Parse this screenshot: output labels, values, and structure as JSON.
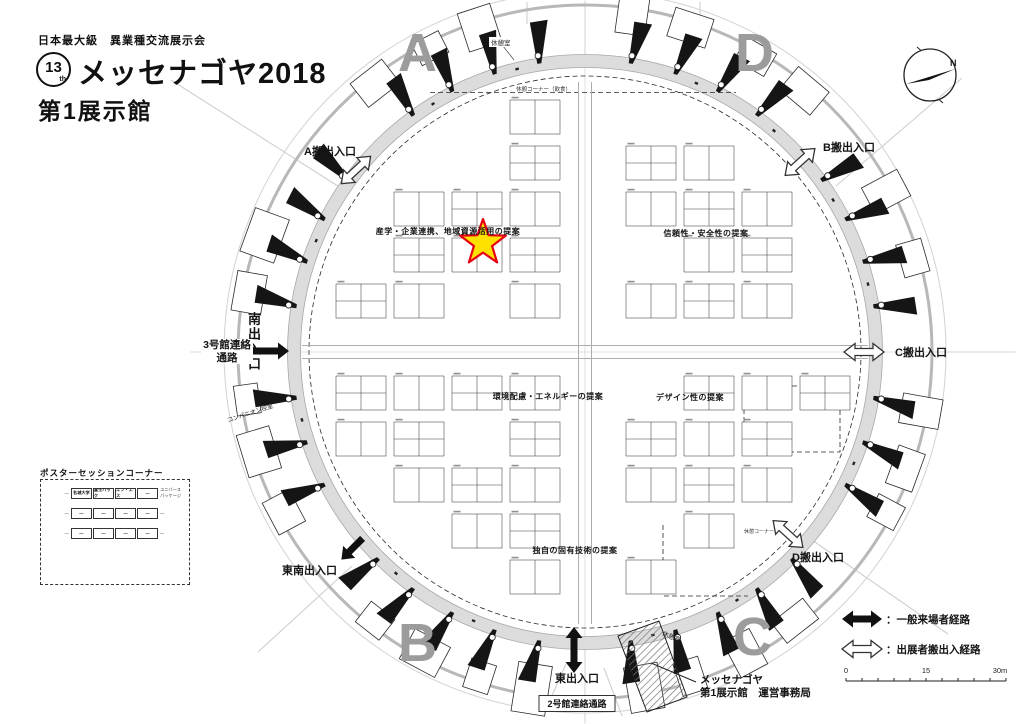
{
  "title": {
    "tagline": "日本最大級　異業種交流展示会",
    "edition_number": "13",
    "edition_suffix": "th",
    "event_name": "メッセナゴヤ2018",
    "hall_name": "第1展示館"
  },
  "quadrants": {
    "a": "A",
    "b": "B",
    "c": "C",
    "d": "D"
  },
  "entrances": {
    "a_load": "A搬出入口",
    "b_load": "B搬出入口",
    "c_load": "C搬出入口",
    "d_load": "D搬出入口",
    "south": "南出入口",
    "southeast": "東南出入口",
    "east": "東出入口"
  },
  "corridors": {
    "hall3": "3号館連絡通路",
    "hall2": "2号館連絡通路"
  },
  "zones": {
    "sangaku": "産学・企業連携、地域資源活用の提案",
    "shinrai": "信頼性・安全性の提案",
    "kankyo": "環境配慮・エネルギーの提案",
    "design": "デザイン性の提案",
    "dokuji": "独自の固有技術の提案"
  },
  "rooms": {
    "rest_top": "休憩室",
    "rest_bottom": "休憩室",
    "companion": "コンパニオン控室",
    "rest_corner_top": "休憩コーナー（飲食）",
    "rest_corner_right": "休憩コーナー"
  },
  "office": {
    "line1": "メッセナゴヤ",
    "line2": "第1展示館　運営事務局"
  },
  "poster": {
    "title": "ポスターセッションコーナー",
    "left_labels": [
      "—",
      "—",
      "—"
    ],
    "rows": [
      [
        "名城大学",
        "富士パック",
        "エフ・エス",
        "—"
      ],
      [
        "—",
        "—",
        "—",
        "—"
      ],
      [
        "—",
        "—",
        "—",
        "—"
      ]
    ],
    "right_labels": [
      "ユニバースパッケージ",
      "—",
      "—"
    ]
  },
  "legend": {
    "visitor": "：一般来場者経路",
    "exhibitor": "：出展者搬出入経路",
    "scale_start": "0",
    "scale_mid": "15",
    "scale_end": "30m"
  },
  "compass": {
    "north": "N"
  },
  "colors": {
    "star_fill": "#FFE100",
    "star_stroke": "#E60012",
    "ring": "#dcdcdc",
    "quadrant_letter": "#9c9c9c"
  }
}
